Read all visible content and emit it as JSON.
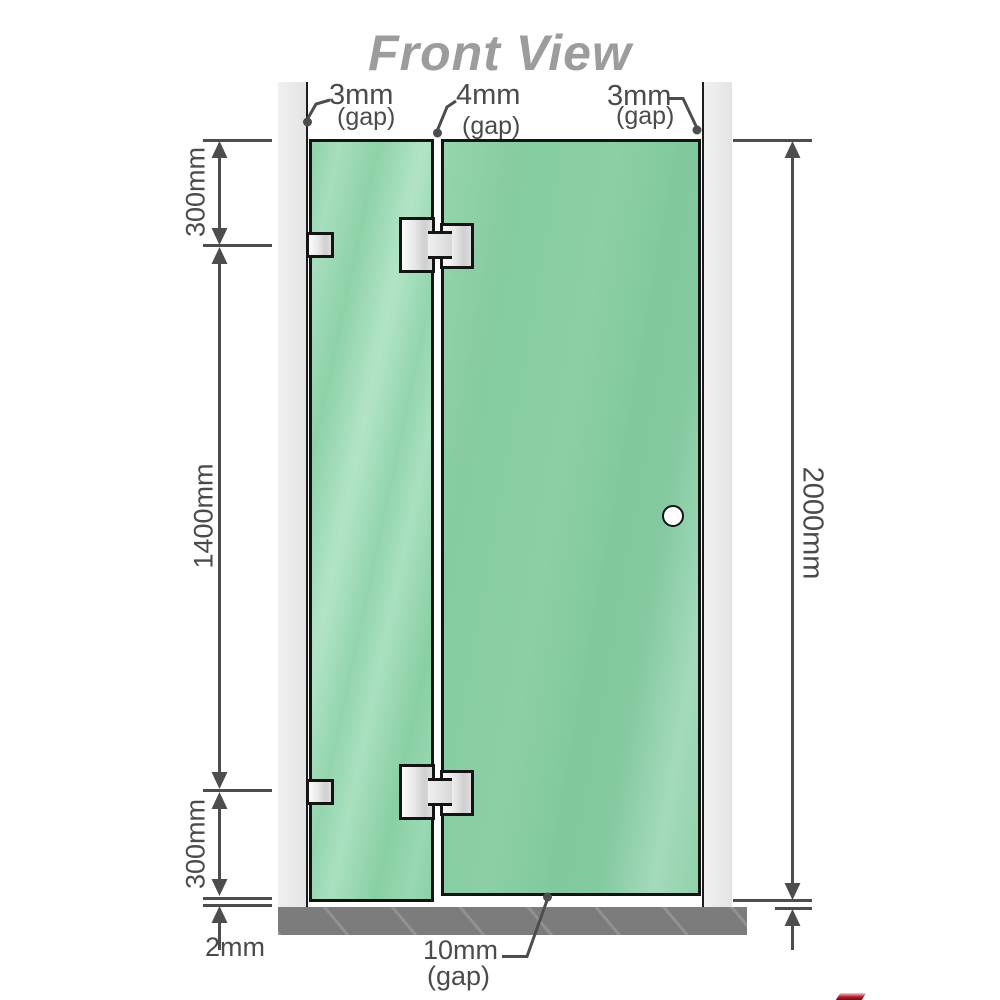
{
  "title": "Front View",
  "labels": {
    "gap_top_left": {
      "value": "3mm",
      "qualifier": "(gap)"
    },
    "gap_top_middle": {
      "value": "4mm",
      "qualifier": "(gap)"
    },
    "gap_top_right": {
      "value": "3mm",
      "qualifier": "(gap)"
    },
    "dim_left_top": "300mm",
    "dim_left_middle": "1400mm",
    "dim_left_bottom": "300mm",
    "dim_bottom_left": "2mm",
    "dim_right_height": "2000mm",
    "gap_bottom": {
      "value": "10mm",
      "qualifier": "(gap)"
    }
  },
  "colors": {
    "glass_green": "#84c9a0",
    "glass_highlight": "#aee0c4",
    "wall_gray": "#e9e9e9",
    "floor_gray": "#7c7c7c",
    "dimension_line_gray": "#4d4d4d",
    "title_gray": "#9c9c9c",
    "hinge_metal": "#ececec",
    "corner_mark_red": "#a01224"
  }
}
